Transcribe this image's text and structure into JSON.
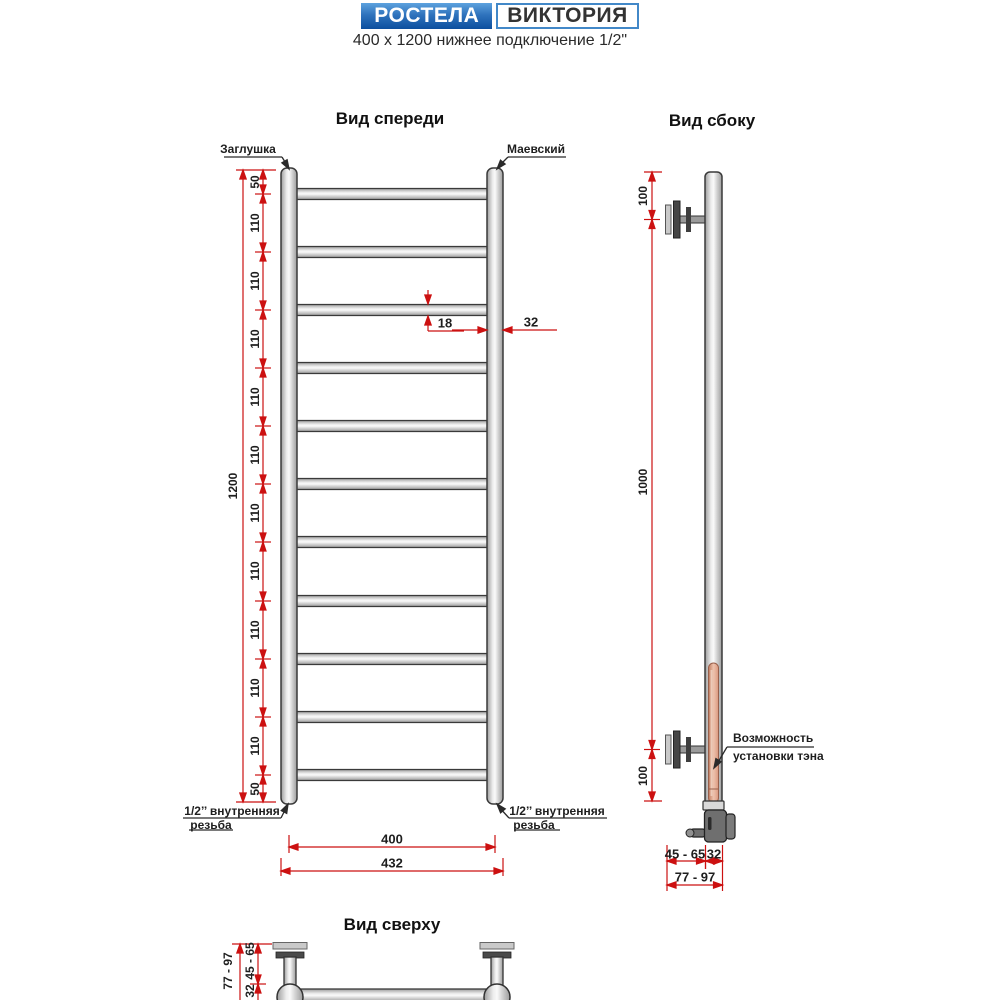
{
  "header": {
    "brand": "РОСТЕЛА",
    "model": "ВИКТОРИЯ",
    "subtitle": "400 x 1200 нижнее подключение 1/2\"",
    "brand_blue_top": "#5da2de",
    "brand_blue_bottom": "#0c4f9e",
    "accent_border_blue": "#4288c8",
    "dimension_red": "#cc1111"
  },
  "front_view": {
    "title": "Вид спереди",
    "label_plug": "Заглушка",
    "label_air_valve": "Маевский",
    "thread_left_line1": "1/2’’ внутренняя",
    "thread_left_line2": "резьба",
    "thread_right_line1": "1/2’’ внутренняя",
    "thread_right_line2": "резьба",
    "overall_height": "1200",
    "segments": [
      "50",
      "110",
      "110",
      "110",
      "110",
      "110",
      "110",
      "110",
      "110",
      "110",
      "110",
      "50"
    ],
    "rung_count": 11,
    "rung_diameter": "18",
    "tube_diameter": "32",
    "axis_width": "400",
    "overall_width": "432"
  },
  "side_view": {
    "title": "Вид сбоку",
    "dim_top": "100",
    "dim_middle": "1000",
    "dim_bottom": "100",
    "note_line1": "Возможность",
    "note_line2": "установки тэна",
    "dim_depth_range": "45 - 65",
    "dim_tube": "32",
    "dim_total_range": "77 - 97"
  },
  "top_view": {
    "title": "Вид сверху",
    "dim_total_range": "77 - 97",
    "dim_depth_range": "45 - 65",
    "dim_tube": "32"
  }
}
